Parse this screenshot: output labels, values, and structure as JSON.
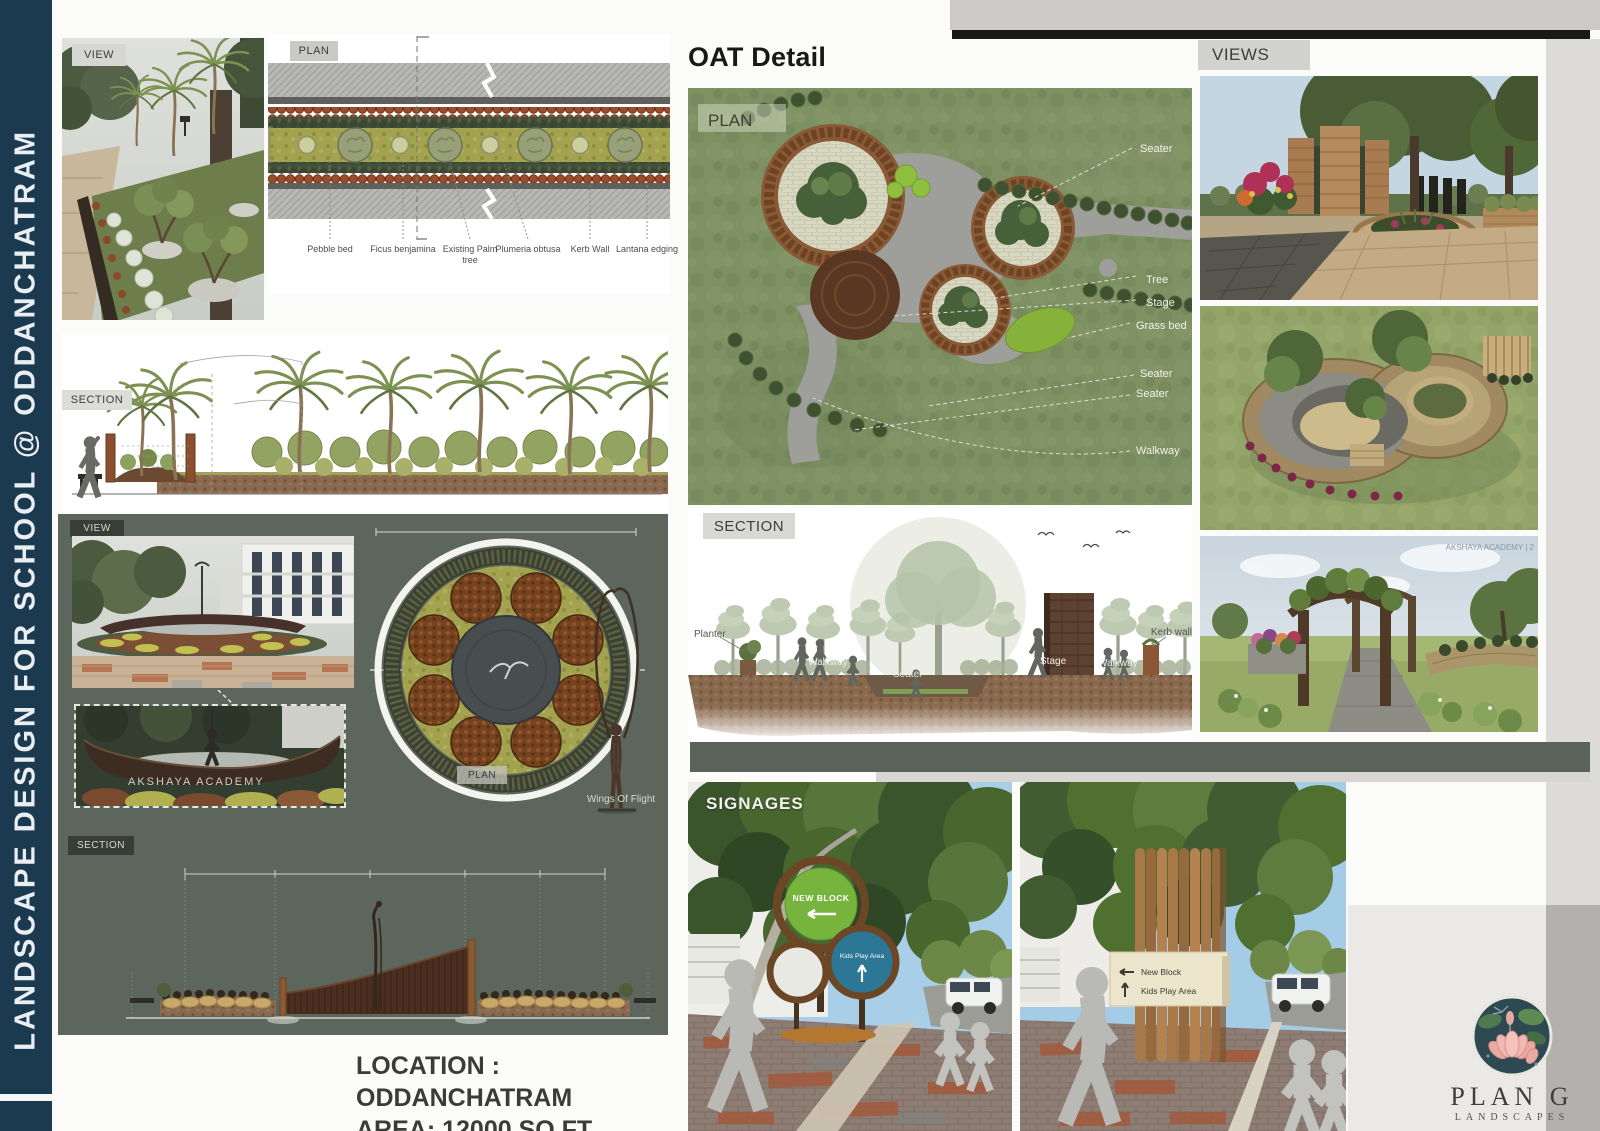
{
  "sidebar": {
    "title": "LANDSCAPE DESIGN FOR SCHOOL @ ODDANCHATRAM"
  },
  "avenue": {
    "view_tag": "VIEW",
    "plan_tag": "PLAN",
    "section_tag": "SECTION",
    "plan_callouts": [
      "Pebble bed",
      "Ficus benjamina",
      "Existing Palm tree",
      "Plumeria obtusa",
      "Kerb Wall",
      "Lantana edging"
    ]
  },
  "entrance": {
    "view_tag": "VIEW",
    "plan_tag": "PLAN",
    "section_tag": "SECTION",
    "boat_text": "AKSHAYA ACADEMY",
    "sculpture_label": "Wings Of Flight"
  },
  "oat": {
    "title": "OAT Detail",
    "plan_tag": "PLAN",
    "section_tag": "SECTION",
    "plan_callouts": [
      "Seater",
      "Tree",
      "Stage",
      "Grass bed",
      "Seater",
      "Seater",
      "Walkway"
    ],
    "section_callouts": [
      "Planter",
      "Walkway",
      "Seater",
      "Stage",
      "Walkway",
      "Kerb wall"
    ]
  },
  "views": {
    "title": "VIEWS",
    "watermark": "AKSHAYA ACADEMY | 2"
  },
  "signages": {
    "title": "SIGNAGES",
    "sign_round": {
      "new_block": "NEW BLOCK",
      "kids_play": "Kids Play Area"
    },
    "sign_board": {
      "new_block": "New Block",
      "kids_play": "Kids Play Area"
    }
  },
  "footer": {
    "location": "LOCATION : ODDANCHATRAM",
    "area": "AREA: 12000 SQ.FT"
  },
  "logo": {
    "name": "PLAN G",
    "subtitle": "LANDSCAPES"
  },
  "colors": {
    "sidebar_navy": "#1c3a4f",
    "panel_sage": "#5c665c",
    "sign_green": "#76b43e",
    "sign_blue": "#2c7795"
  }
}
